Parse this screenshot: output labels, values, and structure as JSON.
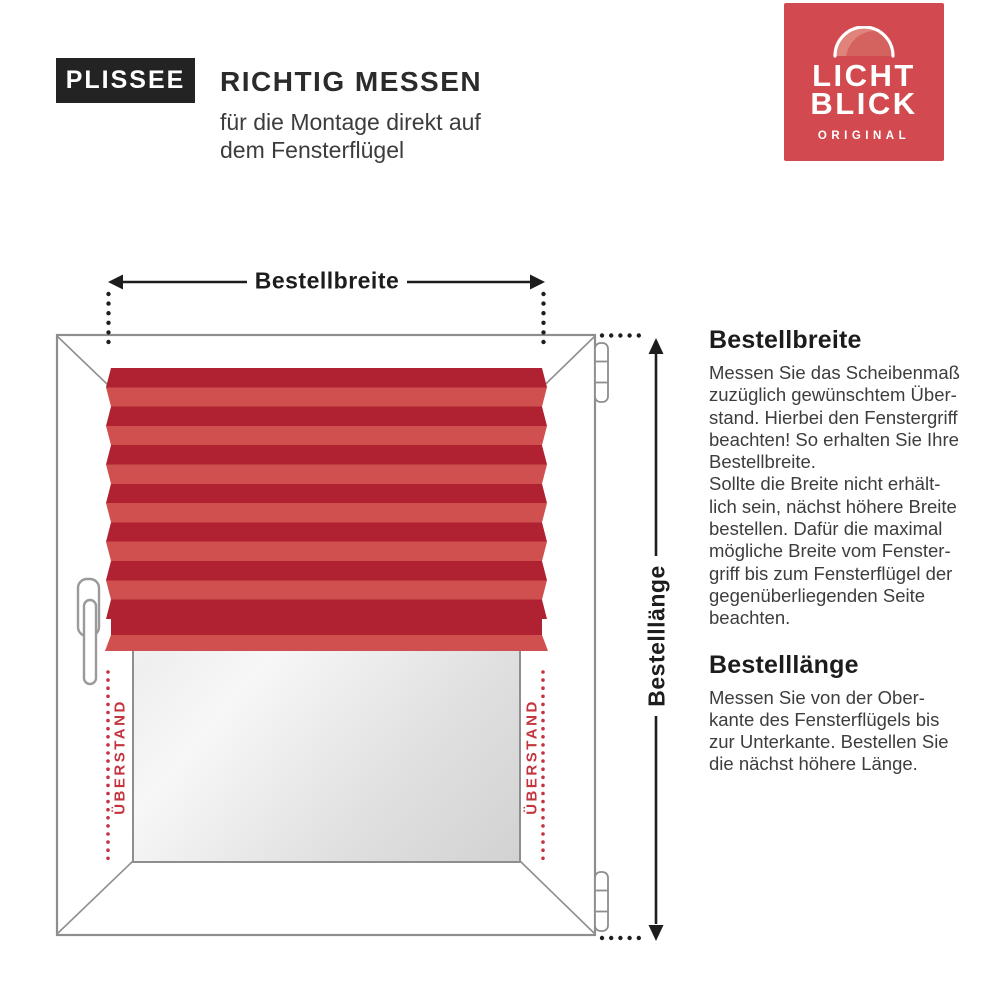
{
  "header": {
    "badge": "PLISSEE",
    "title": "RICHTIG MESSEN",
    "subtitle": "für die Montage direkt auf\ndem Fensterflügel"
  },
  "logo": {
    "line1": "LICHT",
    "line2": "BLICK",
    "tagline": "ORIGINAL"
  },
  "diagram": {
    "width_label": "Bestellbreite",
    "length_label": "Bestelllänge",
    "overhang_left": "ÜBERSTAND",
    "overhang_right": "ÜBERSTAND"
  },
  "instructions": {
    "section1": {
      "heading": "Bestellbreite",
      "body": "Messen Sie das Scheibenmaß\nzuzüglich gewünschtem Über-\nstand. Hierbei den Fenstergriff\nbeachten! So erhalten Sie Ihre\nBestellbreite.\nSollte die Breite nicht erhält-\nlich sein, nächst höhere Breite\nbestellen. Dafür die maximal\nmögliche Breite vom Fenster-\ngriff bis zum Fensterflügel der\ngegenüberliegenden Seite\nbeachten."
    },
    "section2": {
      "heading": "Bestelllänge",
      "body": "Messen Sie von der Ober-\nkante des Fensterflügels bis\nzur Unterkante. Bestellen Sie\ndie nächst höhere Länge."
    }
  },
  "colors": {
    "brand_red": "#d24a4f",
    "blind_dark_red": "#b02132",
    "blind_light_red": "#d0504f",
    "overhang_red": "#c4343f",
    "badge_black": "#232323",
    "frame_gray": "#8e8e8e",
    "arrow_black": "#1d1d1d"
  }
}
